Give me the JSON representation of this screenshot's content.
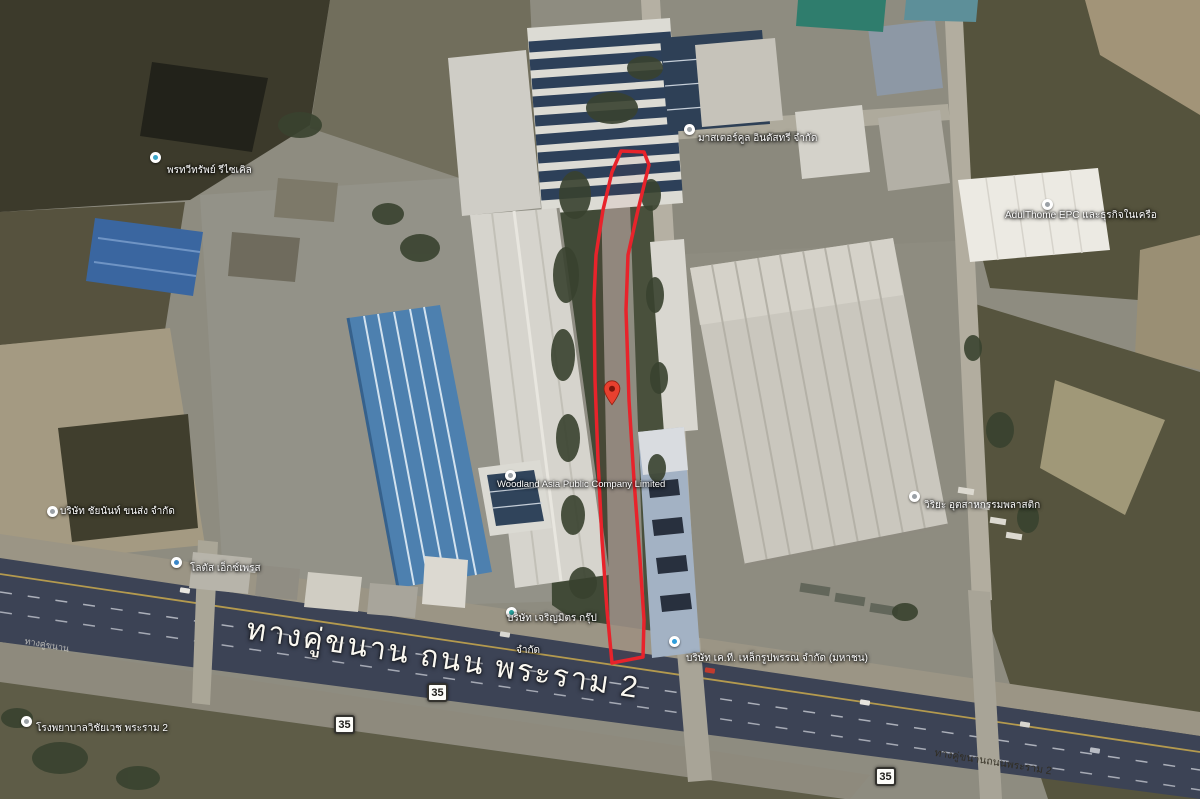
{
  "map": {
    "type": "satellite-aerial",
    "route_number": "35",
    "parcel_outline_color": "#e8232b",
    "marker_color": "#e8402f",
    "road_labels": {
      "main": "ทางคู่ขนาน ถนน พระราม 2",
      "frontage_right": "ทางคู่ขนานถนนพระราม 2",
      "frontage_left": "ทางคู่ขนาน"
    },
    "pois": [
      {
        "text": "พรทวีทรัพย์ รีไซเคิล"
      },
      {
        "text": "มาสเตอร์คูล อินดัสทรี จำกัด"
      },
      {
        "text": "AdulThome EPC และธุรกิจในเครือ"
      },
      {
        "text": "วิริยะ อุตสาหกรรมพลาสติก"
      },
      {
        "text": "บริษัท ชัยนันท์ ขนส่ง จำกัด"
      },
      {
        "text": "โลตัส เอ็กซ์เพรส"
      },
      {
        "text": "บริษัท เจริญมิตร กรุ๊ป",
        "text2": "จำกัด"
      },
      {
        "text": "บริษัท เค.ที. เหล็กรูปพรรณ จำกัด (มหาชน)"
      },
      {
        "text": "โรงพยาบาลวิชัยเวช พระราม 2"
      },
      {
        "text": "Woodland Asia Public Company Limited"
      }
    ]
  }
}
